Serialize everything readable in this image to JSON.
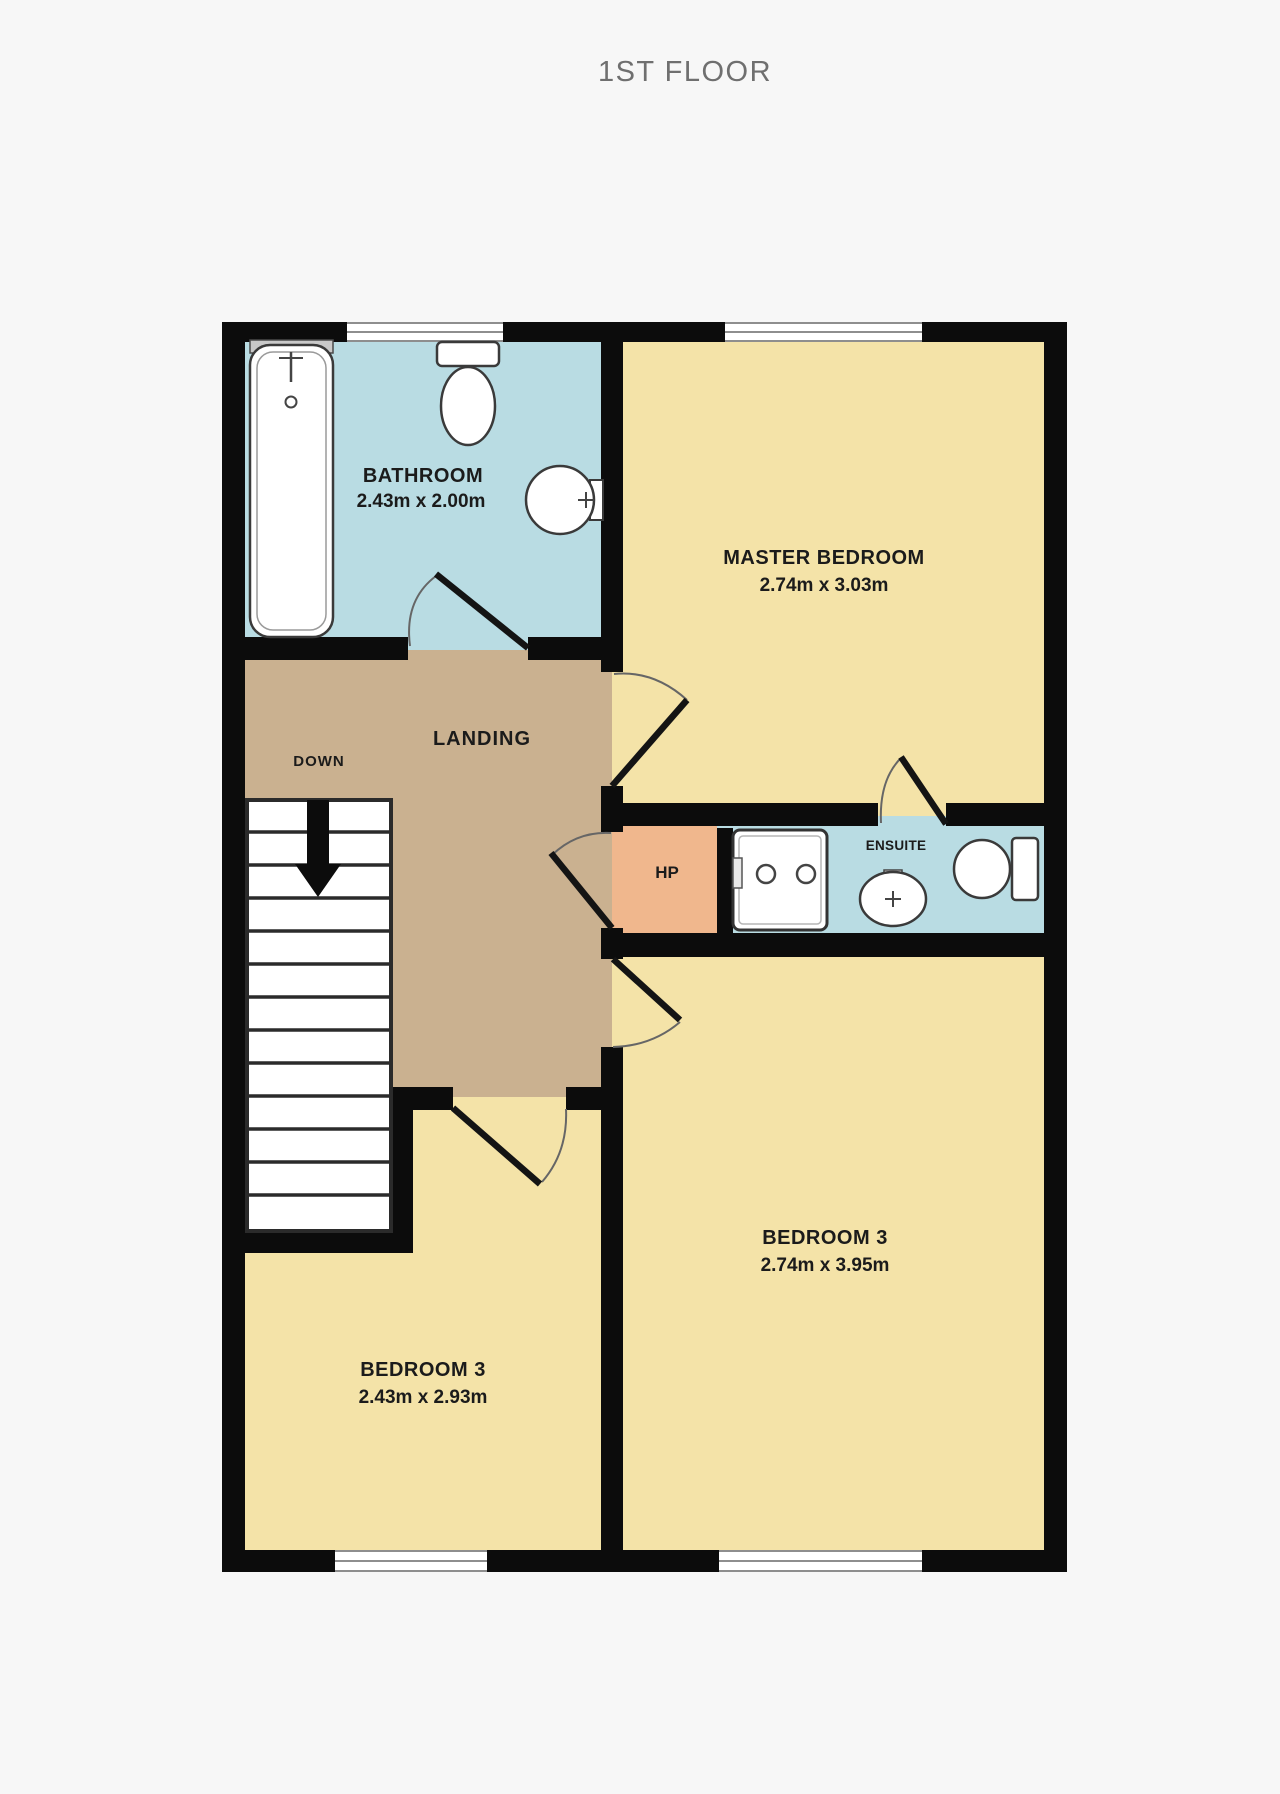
{
  "title": "1ST FLOOR",
  "colors": {
    "wall": "#0c0c0c",
    "bathroom_floor": "#b9dce3",
    "bedroom_floor": "#f4e3a8",
    "landing_floor": "#cab190",
    "hp_closet_floor": "#f0b78d",
    "background": "#f7f7f7",
    "label_text": "#1b1b1b",
    "title_text": "#6f6f6f"
  },
  "rooms": {
    "bathroom": {
      "name": "BATHROOM",
      "dims": "2.43m x 2.00m"
    },
    "master_bedroom": {
      "name": "MASTER BEDROOM",
      "dims": "2.74m x 3.03m"
    },
    "landing": {
      "name": "LANDING"
    },
    "stairs": {
      "direction": "DOWN"
    },
    "hp": {
      "name": "HP"
    },
    "ensuite": {
      "name": "ENSUITE"
    },
    "bedroom3_right": {
      "name": "BEDROOM 3",
      "dims": "2.74m x 3.95m"
    },
    "bedroom3_left": {
      "name": "BEDROOM 3",
      "dims": "2.43m x 2.93m"
    }
  }
}
